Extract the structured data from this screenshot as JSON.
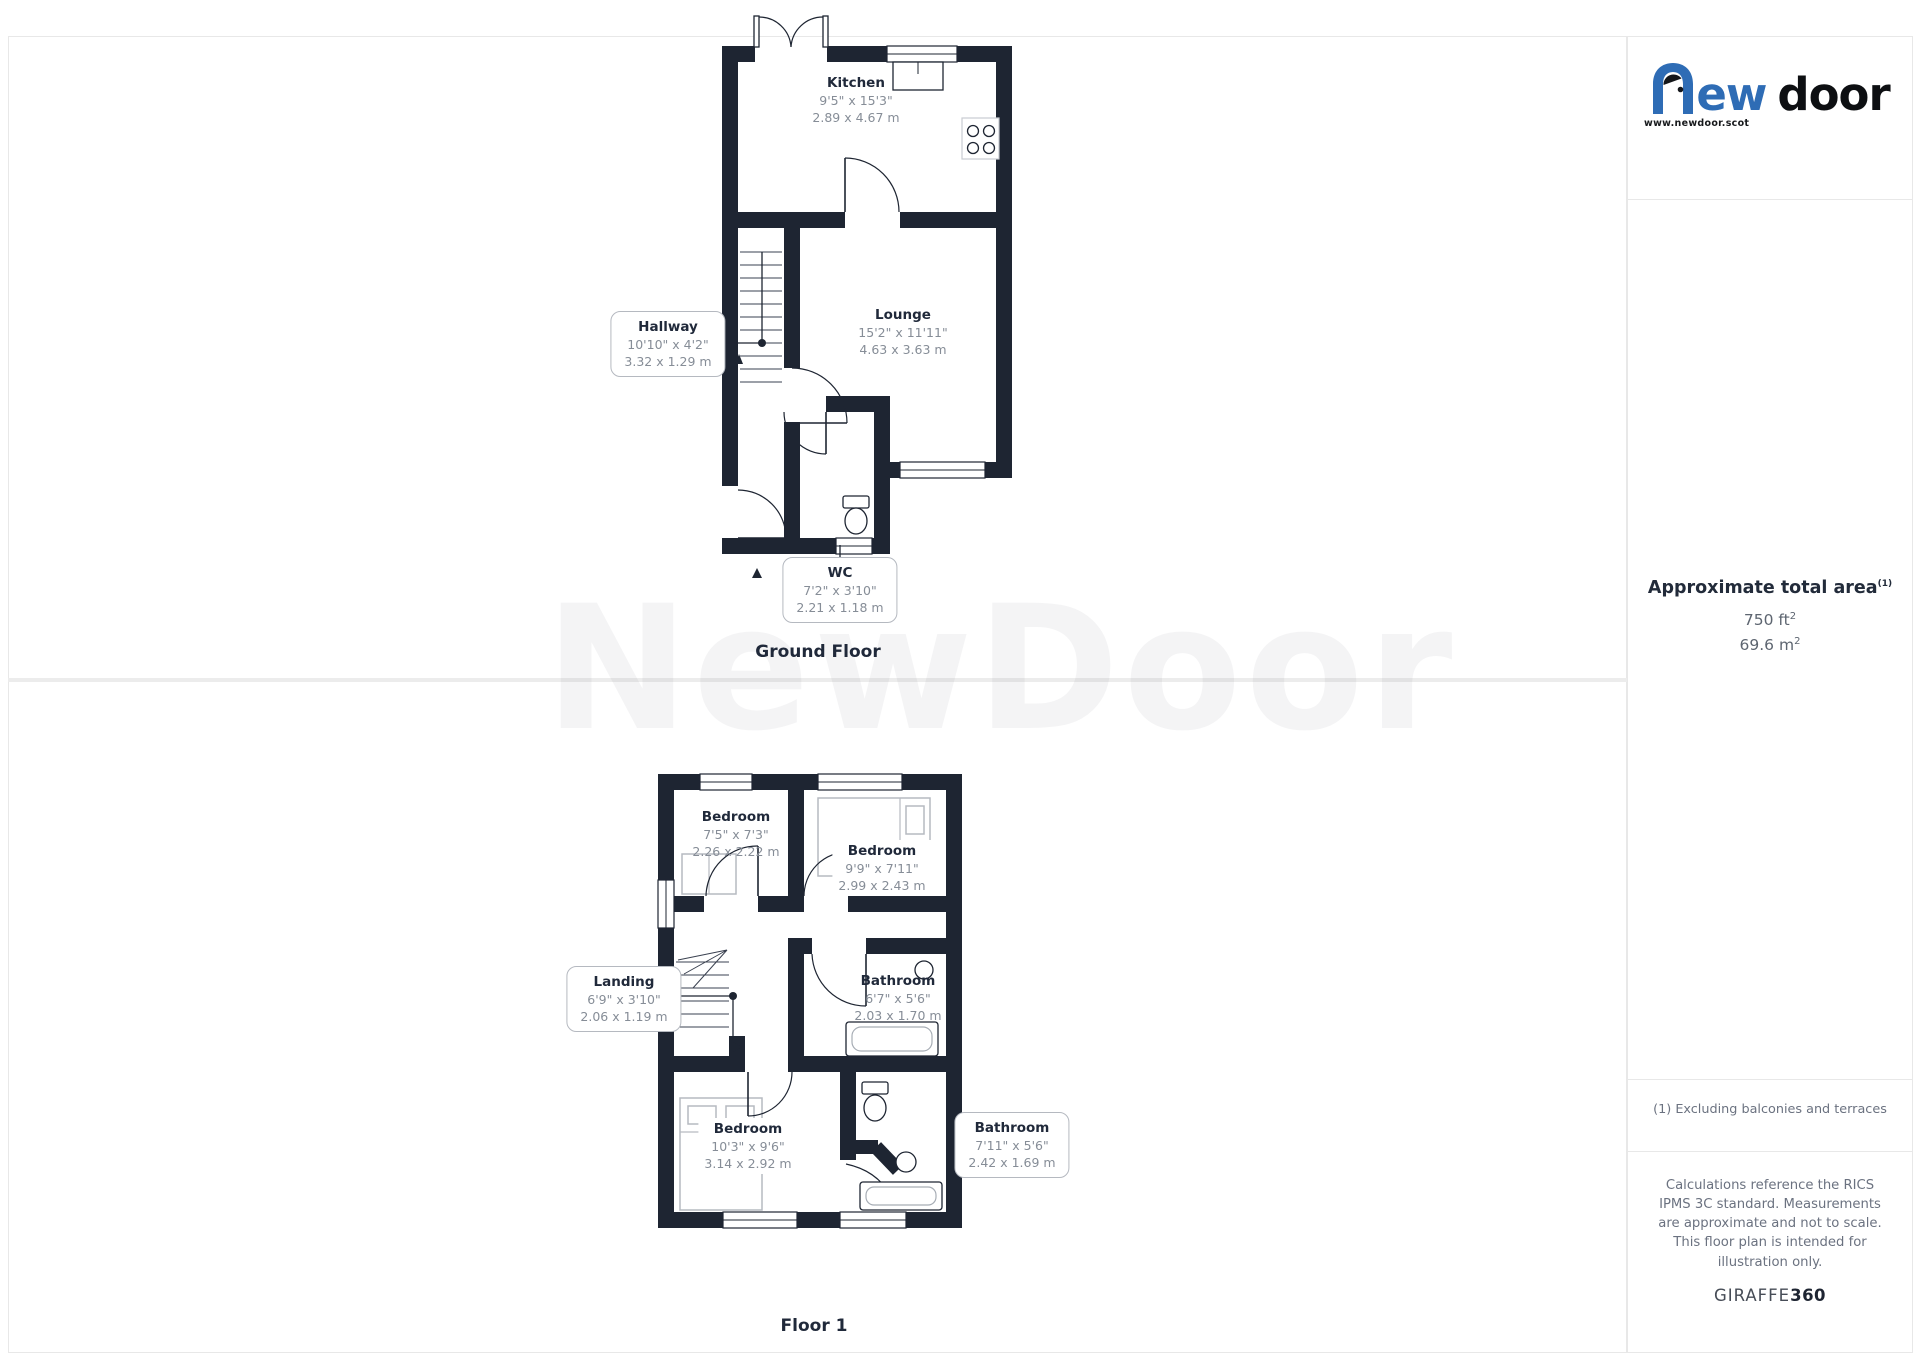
{
  "page": {
    "background": "#ffffff",
    "border_color": "#e8e8e8",
    "wall_color": "#1e2532",
    "watermark": "NewDoor"
  },
  "ground_floor": {
    "title": "Ground Floor",
    "kitchen": {
      "name": "Kitchen",
      "imperial": "9'5\" x 15'3\"",
      "metric": "2.89 x 4.67 m"
    },
    "hallway": {
      "name": "Hallway",
      "imperial": "10'10\" x 4'2\"",
      "metric": "3.32 x 1.29 m"
    },
    "lounge": {
      "name": "Lounge",
      "imperial": "15'2\" x 11'11\"",
      "metric": "4.63 x 3.63 m"
    },
    "wc": {
      "name": "WC",
      "imperial": "7'2\" x 3'10\"",
      "metric": "2.21 x 1.18 m"
    }
  },
  "floor_1": {
    "title": "Floor 1",
    "bedroom_1": {
      "name": "Bedroom",
      "imperial": "7'5\" x 7'3\"",
      "metric": "2.26 x 2.22 m"
    },
    "bedroom_2": {
      "name": "Bedroom",
      "imperial": "9'9\" x 7'11\"",
      "metric": "2.99 x 2.43 m"
    },
    "landing": {
      "name": "Landing",
      "imperial": "6'9\" x 3'10\"",
      "metric": "2.06 x 1.19 m"
    },
    "bathroom_1": {
      "name": "Bathroom",
      "imperial": "6'7\" x 5'6\"",
      "metric": "2.03 x 1.70 m"
    },
    "bedroom_3": {
      "name": "Bedroom",
      "imperial": "10'3\" x 9'6\"",
      "metric": "3.14 x 2.92 m"
    },
    "bathroom_2": {
      "name": "Bathroom",
      "imperial": "7'11\" x 5'6\"",
      "metric": "2.42 x 1.69 m"
    }
  },
  "sidebar": {
    "logo": {
      "word_start": "ew",
      "word_end": "door",
      "website": "www.newdoor.scot",
      "blue": "#2e6cb5"
    },
    "area": {
      "title": "Approximate total area",
      "footnote_marker": "(1)",
      "imperial_value": "750 ft",
      "metric_value": "69.6 m",
      "superscript": "2"
    },
    "footnote": "(1) Excluding balconies and terraces",
    "disclaimer": "Calculations reference the RICS IPMS 3C standard. Measurements are approximate and not to scale. This floor plan is intended for illustration only.",
    "brand": {
      "name": "GIRAFFE",
      "suffix": "360"
    }
  }
}
